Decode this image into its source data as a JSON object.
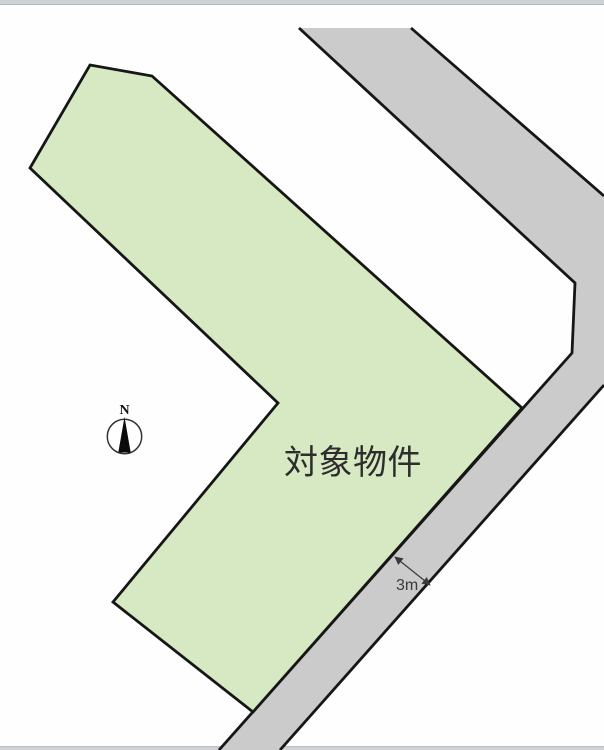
{
  "labels": {
    "parcel": "対象物件",
    "road_width": "3m",
    "compass_north": "N"
  },
  "colors": {
    "page_background": "#fefefe",
    "parcel_fill": "#d7e9c2",
    "road_fill": "#cbcbcb",
    "outline": "#161616",
    "edge_bar": "#cfd2d4",
    "label_text": "#2d2d2d",
    "dimension_text": "#3a3a3a"
  },
  "shapes": {
    "parcel_points": "90,65 152,76 522,408 253,712 113,602 278,403 30,168",
    "road_points": "299,28 411,28 604,196 604,385 280,750 219,750 572,353 575,283",
    "road_inner_edge": "M 299,28 L 575,283 L 572,353 L 219,750",
    "road_outer_edge_upper": "M 411,28 L 604,196",
    "road_outer_edge_lower": "M 604,385 L 280,750",
    "dimension_arrow": "M 395,557 L 430,585",
    "compass_needle_points": "124.5,417 118.3,452.5 130.7,452.5"
  }
}
